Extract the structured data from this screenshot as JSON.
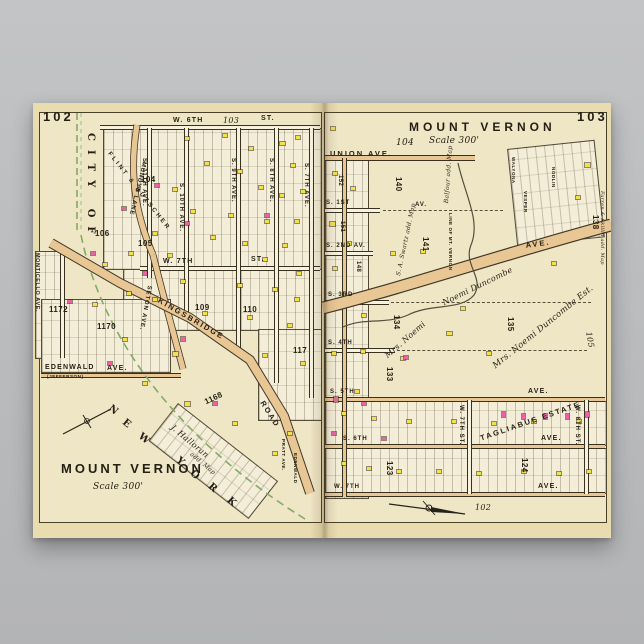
{
  "poster": {
    "paper_color": "#e9dcae",
    "accent_colors": {
      "building_yellow": "#f2e24a",
      "building_pink": "#ee61a7",
      "road_tan": "#e9c795",
      "boundary_green": "#82ab66",
      "ink": "#241f13",
      "background_gray": "#b9babc"
    },
    "left_page": {
      "page_number": "102",
      "xref_top": "103",
      "title": "MOUNT VERNON",
      "scale": "Scale 300'",
      "city_of": "CITY OF",
      "ny": [
        "N",
        "E",
        "W",
        "Y",
        "O",
        "R",
        "K"
      ],
      "monticello": "MONTICELLO AVE.",
      "mundys": "MUNDYS LANE",
      "seton": "SETON AVE.",
      "w6": "W. 6TH",
      "w6_suffix": "ST.",
      "w7": "W. 7TH",
      "w7_suffix": "ST.",
      "aves": [
        "S. 11TH AVE.",
        "S. 10TH AVE.",
        "S. 9TH AVE.",
        "S. 8TH AVE.",
        "S. 7TH AVE."
      ],
      "kingsbridge": "KINGSBRIDGE",
      "kingsbridge2": "ROAD",
      "edenwald": "EDENWALD",
      "edenwald_ave": "AVE.",
      "jefferson": "(JEFFERSON)",
      "estate": "FLINT & BUTSCHER",
      "halloran": "J. Halloran",
      "halloran2": "add. Map",
      "pratt": "PRATT AVE.",
      "edenwald_v": "EDENWALD",
      "blocks": {
        "b104": "104",
        "b105": "105",
        "b106": "106",
        "b109": "109",
        "b110": "110",
        "b117": "117",
        "b1168": "1168",
        "b1170": "1170",
        "b1172": "1172"
      }
    },
    "right_page": {
      "page_number": "103",
      "title": "MOUNT VERNON",
      "ref": "104",
      "scale": "Scale 300'",
      "union": "UNION AVE.",
      "s1": "S. 1ST",
      "s1_av": "AV.",
      "s2": "S. 2ND AV.",
      "s3": "S. 3RD",
      "s4": "S. 4TH",
      "s5": "S. 5TH",
      "s5_ave": "AVE.",
      "s6": "S. 6TH",
      "s6_ave": "AVE.",
      "w7": "W. 7TH",
      "w7_ave": "AVE.",
      "ave_diag": "AVE.",
      "w7st": "W. 7TH ST.",
      "w8st": "W. 8TH ST.",
      "tagliabue": "TAGLIABUE ESTATE",
      "duncombe1": "Noemi Duncombe",
      "duncombe2": "Mrs. Noemi Duncombe Est.",
      "duncombe3": "Mrs. Noemi",
      "swartz": "S. A. Swartz add. Map",
      "balfour": "Balfour add. Map",
      "line_of": "LINE OF MT. VERNON",
      "farren": "Farren & Skillin add. Map",
      "sub_streets": [
        "WALYONA",
        "VESPER",
        "NODLIN"
      ],
      "blocks": {
        "b140": "140",
        "b141": "141",
        "b134": "134",
        "b135": "135",
        "b133": "133",
        "b138": "138",
        "b148": "148",
        "b151": "151",
        "b152": "152",
        "b123": "123",
        "b124": "124"
      },
      "xref_right": "105",
      "xref_bottom": "102"
    },
    "buildings": [
      [
        152,
        34,
        4,
        3,
        "y"
      ],
      [
        190,
        31,
        4,
        3,
        "y"
      ],
      [
        216,
        44,
        4,
        3,
        "y"
      ],
      [
        247,
        39,
        5,
        3,
        "y"
      ],
      [
        263,
        33,
        4,
        3,
        "y"
      ],
      [
        172,
        59,
        4,
        3,
        "y"
      ],
      [
        205,
        67,
        4,
        3,
        "y"
      ],
      [
        258,
        61,
        4,
        3,
        "y"
      ],
      [
        140,
        85,
        4,
        3,
        "y"
      ],
      [
        226,
        83,
        4,
        3,
        "y"
      ],
      [
        247,
        91,
        4,
        3,
        "y"
      ],
      [
        268,
        87,
        4,
        3,
        "y"
      ],
      [
        158,
        107,
        4,
        3,
        "y"
      ],
      [
        196,
        111,
        4,
        3,
        "y"
      ],
      [
        232,
        117,
        4,
        3,
        "y"
      ],
      [
        262,
        117,
        4,
        3,
        "y"
      ],
      [
        120,
        129,
        4,
        3,
        "y"
      ],
      [
        178,
        133,
        4,
        3,
        "y"
      ],
      [
        210,
        139,
        4,
        3,
        "y"
      ],
      [
        250,
        141,
        4,
        3,
        "y"
      ],
      [
        96,
        149,
        4,
        3,
        "y"
      ],
      [
        135,
        151,
        4,
        3,
        "y"
      ],
      [
        230,
        155,
        4,
        3,
        "y"
      ],
      [
        264,
        169,
        4,
        3,
        "y"
      ],
      [
        148,
        177,
        4,
        3,
        "y"
      ],
      [
        205,
        181,
        4,
        3,
        "y"
      ],
      [
        240,
        185,
        4,
        3,
        "y"
      ],
      [
        94,
        189,
        4,
        3,
        "y"
      ],
      [
        120,
        195,
        4,
        3,
        "y"
      ],
      [
        262,
        195,
        4,
        3,
        "y"
      ],
      [
        170,
        209,
        4,
        3,
        "y"
      ],
      [
        215,
        213,
        4,
        3,
        "y"
      ],
      [
        255,
        221,
        4,
        3,
        "y"
      ],
      [
        90,
        235,
        4,
        3,
        "y"
      ],
      [
        140,
        249,
        5,
        4,
        "y"
      ],
      [
        230,
        251,
        4,
        3,
        "y"
      ],
      [
        268,
        259,
        4,
        3,
        "y"
      ],
      [
        110,
        279,
        4,
        3,
        "y"
      ],
      [
        152,
        299,
        5,
        4,
        "y"
      ],
      [
        200,
        319,
        4,
        3,
        "y"
      ],
      [
        240,
        349,
        4,
        3,
        "y"
      ],
      [
        255,
        329,
        4,
        3,
        "y"
      ],
      [
        70,
        160,
        4,
        3,
        "y"
      ],
      [
        60,
        200,
        4,
        3,
        "y"
      ],
      [
        122,
        81,
        4,
        3,
        "p"
      ],
      [
        89,
        104,
        4,
        3,
        "p"
      ],
      [
        232,
        111,
        4,
        3,
        "p"
      ],
      [
        152,
        119,
        4,
        3,
        "p"
      ],
      [
        58,
        149,
        4,
        3,
        "p"
      ],
      [
        110,
        169,
        4,
        3,
        "p"
      ],
      [
        35,
        197,
        4,
        3,
        "p"
      ],
      [
        148,
        234,
        4,
        4,
        "p"
      ],
      [
        75,
        259,
        4,
        3,
        "p"
      ],
      [
        180,
        299,
        4,
        3,
        "p"
      ],
      [
        298,
        24,
        4,
        3,
        "y"
      ],
      [
        552,
        60,
        5,
        4,
        "y"
      ],
      [
        543,
        93,
        4,
        3,
        "y"
      ],
      [
        300,
        69,
        4,
        3,
        "y"
      ],
      [
        318,
        84,
        4,
        3,
        "y"
      ],
      [
        297,
        119,
        5,
        4,
        "y"
      ],
      [
        314,
        139,
        4,
        3,
        "y"
      ],
      [
        300,
        164,
        4,
        3,
        "y"
      ],
      [
        329,
        211,
        4,
        3,
        "y"
      ],
      [
        358,
        149,
        4,
        3,
        "y"
      ],
      [
        388,
        147,
        4,
        3,
        "y"
      ],
      [
        299,
        249,
        4,
        3,
        "y"
      ],
      [
        328,
        247,
        4,
        3,
        "y"
      ],
      [
        414,
        229,
        5,
        3,
        "y"
      ],
      [
        454,
        249,
        4,
        3,
        "y"
      ],
      [
        519,
        159,
        4,
        3,
        "y"
      ],
      [
        309,
        309,
        4,
        3,
        "y"
      ],
      [
        339,
        314,
        4,
        3,
        "y"
      ],
      [
        374,
        317,
        4,
        3,
        "y"
      ],
      [
        419,
        317,
        4,
        3,
        "y"
      ],
      [
        459,
        319,
        4,
        3,
        "y"
      ],
      [
        499,
        317,
        4,
        3,
        "y"
      ],
      [
        544,
        317,
        4,
        3,
        "y"
      ],
      [
        309,
        359,
        4,
        3,
        "y"
      ],
      [
        334,
        364,
        4,
        3,
        "y"
      ],
      [
        364,
        367,
        4,
        3,
        "y"
      ],
      [
        404,
        367,
        4,
        3,
        "y"
      ],
      [
        444,
        369,
        4,
        3,
        "y"
      ],
      [
        489,
        367,
        4,
        3,
        "y"
      ],
      [
        524,
        369,
        4,
        3,
        "y"
      ],
      [
        554,
        367,
        4,
        3,
        "y"
      ],
      [
        428,
        204,
        4,
        3,
        "y"
      ],
      [
        368,
        254,
        4,
        3,
        "y"
      ],
      [
        322,
        287,
        4,
        3,
        "y"
      ],
      [
        301,
        294,
        4,
        5,
        "p"
      ],
      [
        329,
        299,
        4,
        3,
        "p"
      ],
      [
        469,
        309,
        3,
        5,
        "p"
      ],
      [
        489,
        311,
        3,
        5,
        "p"
      ],
      [
        511,
        311,
        3,
        5,
        "p"
      ],
      [
        533,
        311,
        3,
        5,
        "p"
      ],
      [
        299,
        329,
        4,
        3,
        "p"
      ],
      [
        349,
        334,
        4,
        3,
        "p"
      ],
      [
        553,
        309,
        3,
        5,
        "p"
      ],
      [
        371,
        253,
        4,
        3,
        "p"
      ]
    ]
  }
}
